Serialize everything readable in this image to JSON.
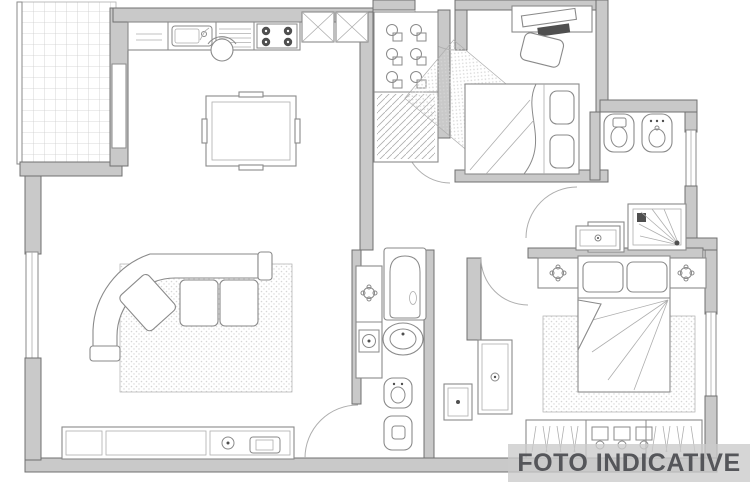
{
  "watermark": {
    "label": "FOTO INDICATIVE"
  },
  "palette": {
    "bg": "#ffffff",
    "wall-fill": "#c9c9c9",
    "wall-stroke": "#707070",
    "line": "#8a8a8a",
    "line-light": "#aeaeae",
    "dark-accent": "#4f4f4f",
    "rug-dot": "#d6d6d6",
    "tile-line": "#cccccc",
    "band-bg": "rgba(203,203,203,0.78)",
    "band-text": "#55565a"
  },
  "plan": {
    "type": "apartment-floor-plan",
    "rooms": [
      {
        "name": "balcony",
        "features": [
          "tiled-floor",
          "railing"
        ]
      },
      {
        "name": "kitchen-living-room",
        "features": [
          "kitchen-counter",
          "kitchen-sink",
          "cooktop",
          "wall-cabinets",
          "dining-table",
          "chair",
          "corner-sofa",
          "rug",
          "tv-sideboard"
        ]
      },
      {
        "name": "hallway",
        "features": [
          "wardrobe-closet",
          "entry-rug",
          "entrance-door"
        ]
      },
      {
        "name": "bedroom-2",
        "features": [
          "desk",
          "desk-chair",
          "single-bed"
        ]
      },
      {
        "name": "bathroom-1",
        "features": [
          "toilet",
          "bidet",
          "washbasin",
          "shower"
        ]
      },
      {
        "name": "bathroom-2",
        "features": [
          "bathtub",
          "pedestal-sink",
          "washing-machine-column",
          "bidet",
          "toilet"
        ]
      },
      {
        "name": "master-bedroom",
        "features": [
          "double-bed",
          "nightstand",
          "nightstand",
          "rug",
          "wardrobe",
          "dresser"
        ]
      }
    ]
  }
}
